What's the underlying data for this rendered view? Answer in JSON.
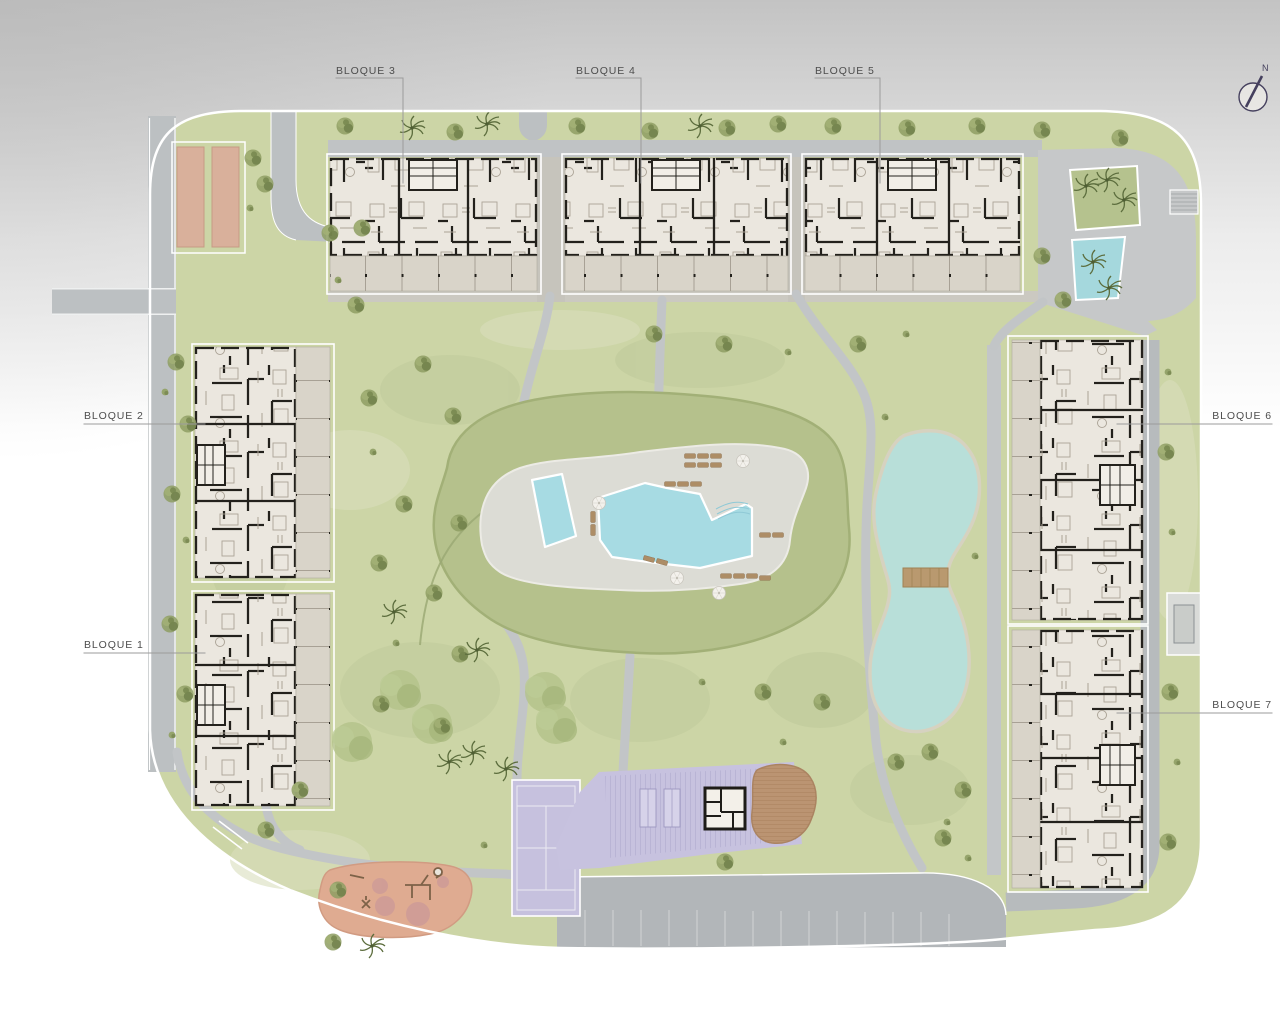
{
  "plan": {
    "type": "residential-site-plan",
    "blocks": [
      {
        "id": "bloque-1",
        "label": "BLOQUE 1"
      },
      {
        "id": "bloque-2",
        "label": "BLOQUE 2"
      },
      {
        "id": "bloque-3",
        "label": "BLOQUE 3"
      },
      {
        "id": "bloque-4",
        "label": "BLOQUE 4"
      },
      {
        "id": "bloque-5",
        "label": "BLOQUE 5"
      },
      {
        "id": "bloque-6",
        "label": "BLOQUE 6"
      },
      {
        "id": "bloque-7",
        "label": "BLOQUE 7"
      }
    ],
    "north_indicator": {
      "label": "N"
    },
    "colors": {
      "grass": "#ccd5a6",
      "mound_green": "#b5c18c",
      "road": "#bcc0c2",
      "plaza": "#cbc9c1",
      "building_fill": "#ebe7df",
      "building_wall": "#23211c",
      "terrace": "#d9d4c9",
      "pool_water": "#a7dbe3",
      "lake_water": "#b8dfd9",
      "lake_shore": "#d6d2c0",
      "amenity_purple": "#c7c2df",
      "playground_salmon": "#dfab91",
      "petanque_sand": "#d9b09b",
      "deck_brown": "#bb9472",
      "label_text": "#4d4d4d",
      "north_stroke": "#45405e"
    }
  }
}
